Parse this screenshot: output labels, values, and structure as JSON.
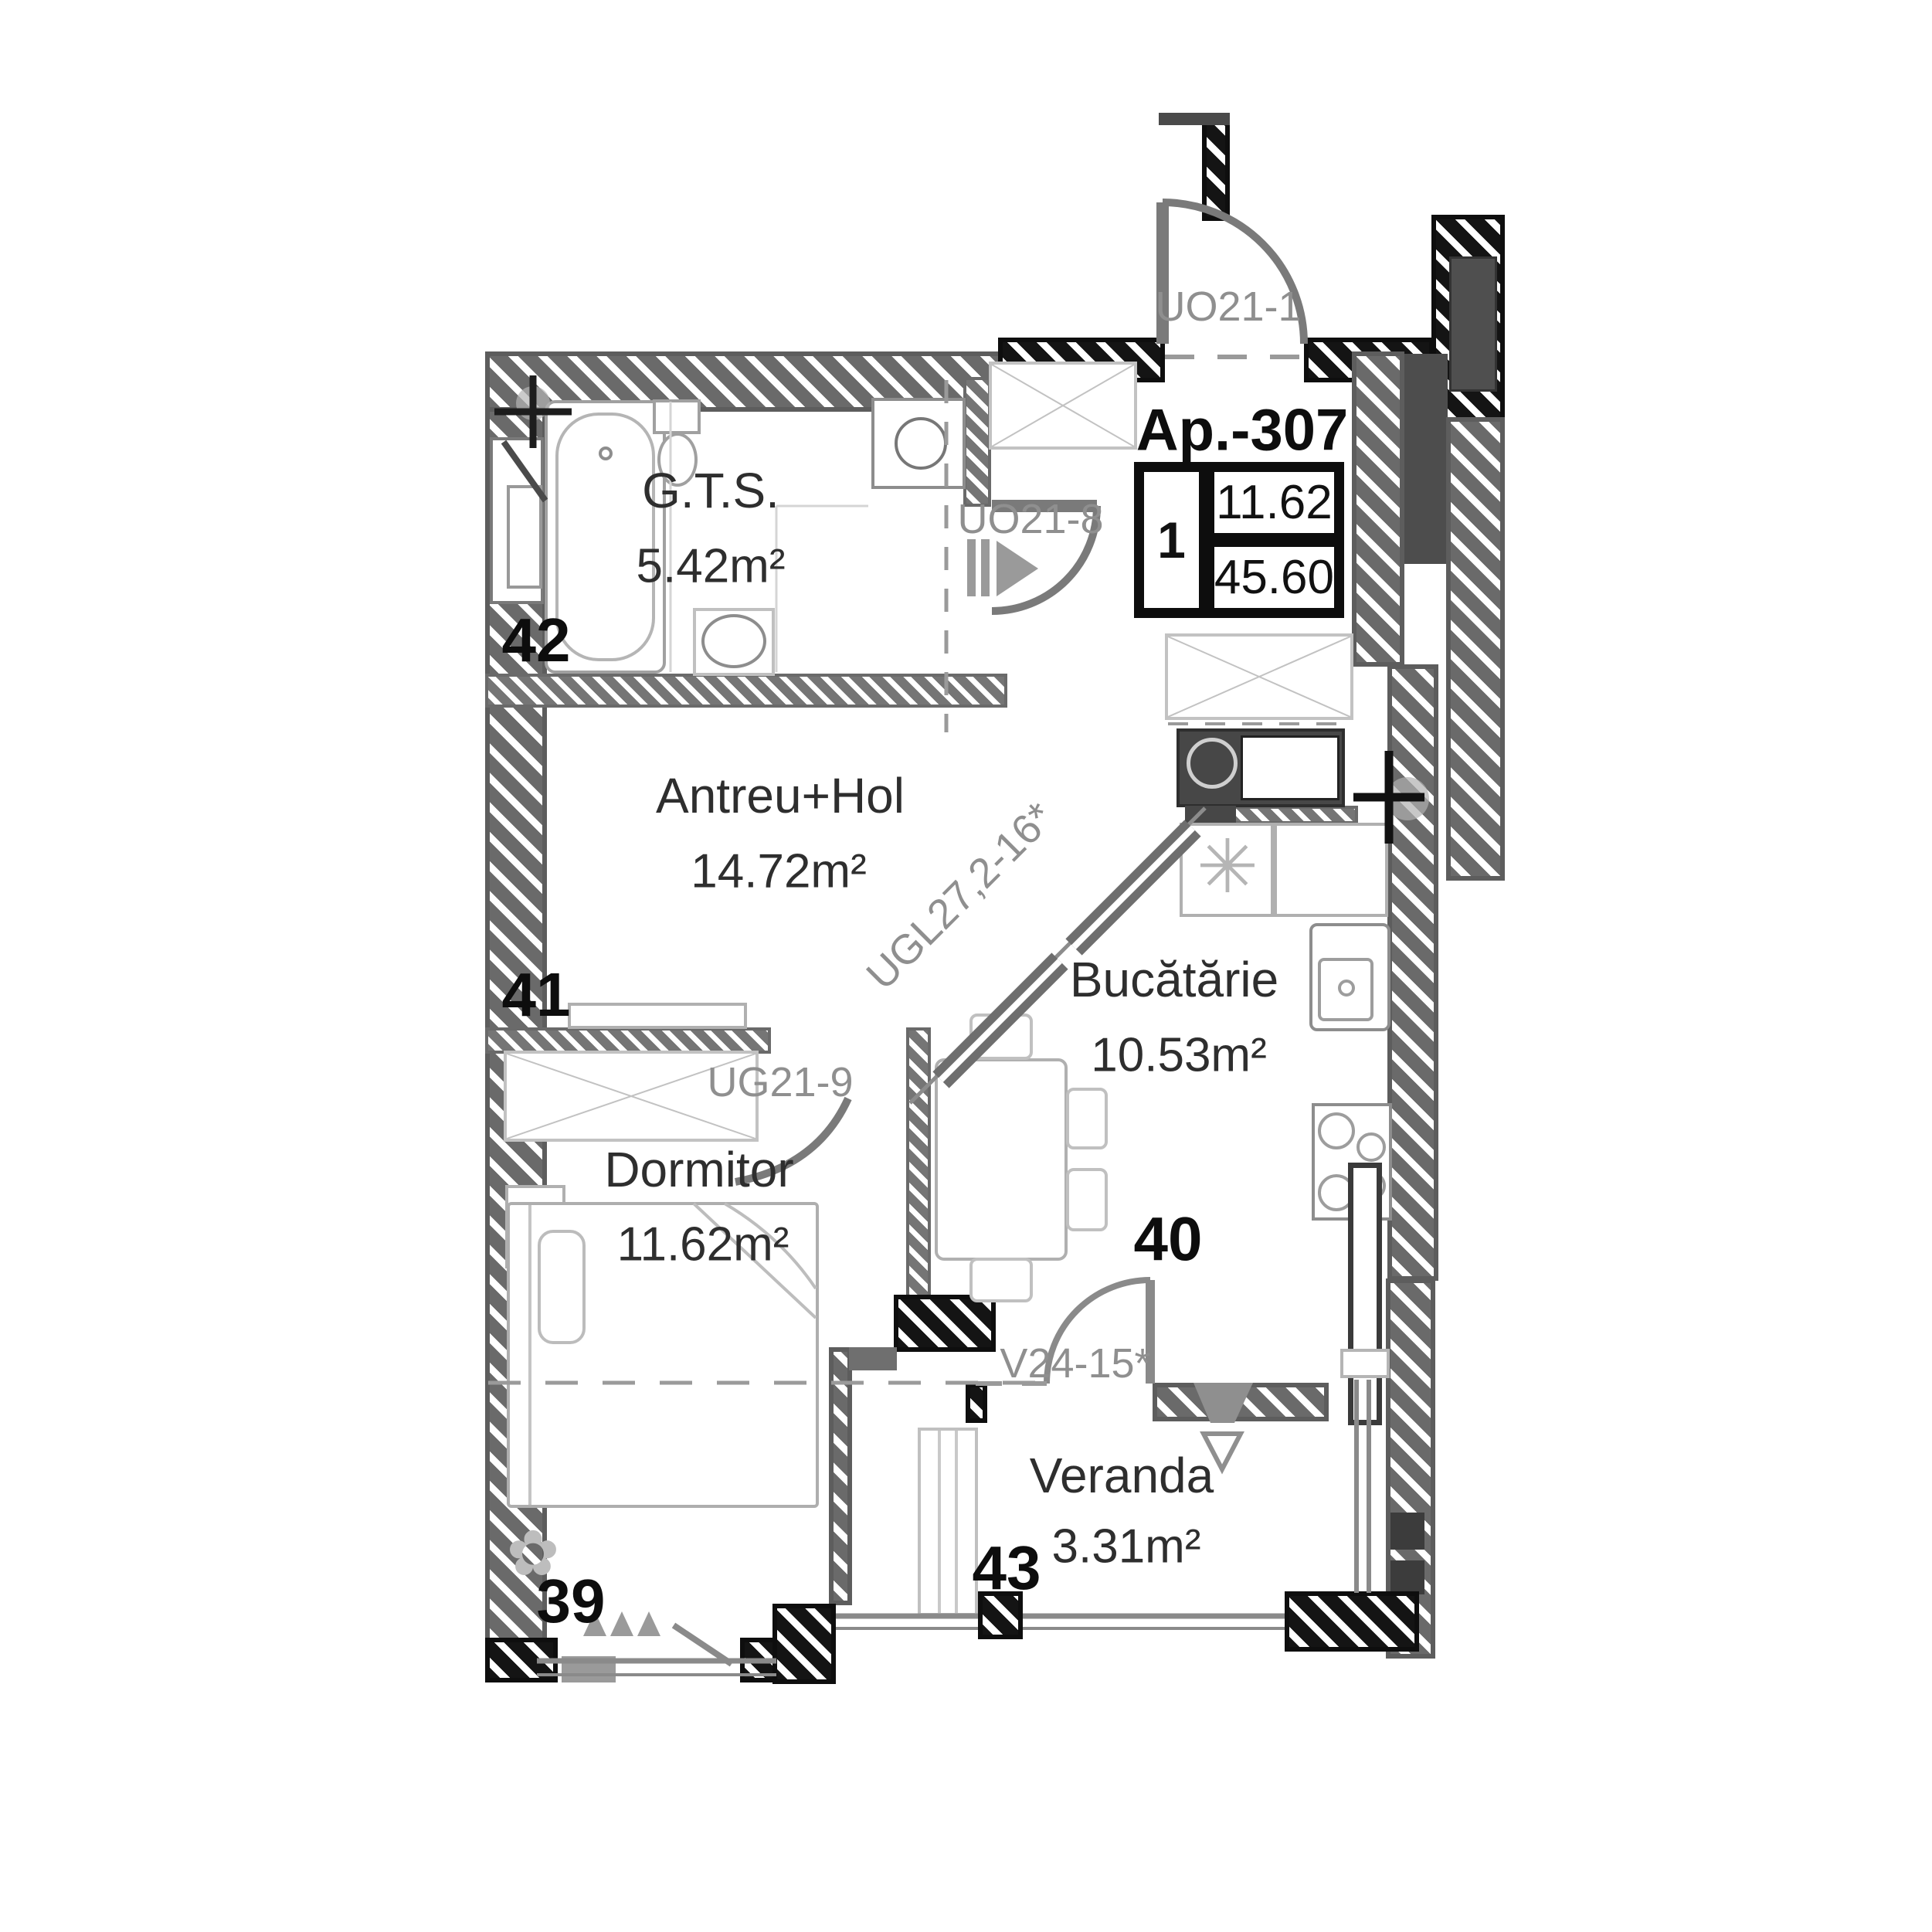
{
  "plan": {
    "apartment": {
      "title": "Ap.-307",
      "rooms_count": "1",
      "living_area": "11.62",
      "total_area": "45.60"
    },
    "rooms": [
      {
        "id": "gts",
        "name": "G.T.S.",
        "area": "5.42m²"
      },
      {
        "id": "antreu",
        "name": "Antreu+Hol",
        "area": "14.72m²"
      },
      {
        "id": "bucatarie",
        "name": "Bucătărie",
        "area": "10.53m²"
      },
      {
        "id": "dormitor",
        "name": "Dormitor",
        "area": "11.62m²"
      },
      {
        "id": "veranda",
        "name": "Veranda",
        "area": "3.31m²"
      }
    ],
    "doors": [
      {
        "code": "UO21-1"
      },
      {
        "code": "UO21-8"
      },
      {
        "code": "UGL27,2-16*"
      },
      {
        "code": "UG21-9"
      },
      {
        "code": "V24-15*"
      }
    ],
    "zone_labels": [
      "39",
      "40",
      "41",
      "42",
      "43"
    ],
    "icons": [
      "bathtub-icon",
      "toilet-icon",
      "washbasin-icon",
      "washing-machine-icon",
      "kitchen-sink-icon",
      "hob-icon",
      "dining-table-icon",
      "chair-icon",
      "bed-icon",
      "wardrobe-icon",
      "plant-icon",
      "radiator-icon",
      "door-swing-icon",
      "entry-arrow-icon",
      "column-marker-icon",
      "lamp-asterisk-icon"
    ],
    "colors": {
      "wall_gray": "#6a6a6a",
      "wall_dark": "#141414",
      "furniture_line": "#a0a0a0",
      "door_code_text": "#8f8f8f",
      "label_text": "#2e2e2e"
    }
  }
}
